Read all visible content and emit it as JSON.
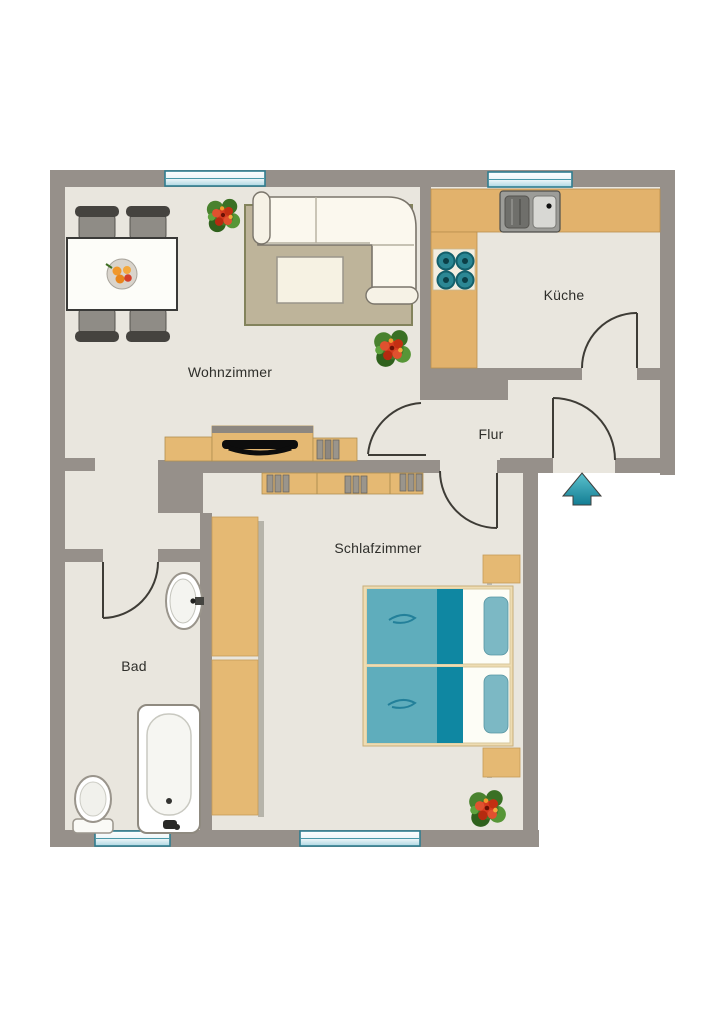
{
  "plan": {
    "type": "apartment-floor-plan",
    "rooms": {
      "wohnzimmer": {
        "label": "Wohnzimmer"
      },
      "kueche": {
        "label": "Küche"
      },
      "flur": {
        "label": "Flur"
      },
      "schlafzimmer": {
        "label": "Schlafzimmer"
      },
      "bad": {
        "label": "Bad"
      }
    },
    "furniture": [
      "dining-table",
      "dining-chair",
      "fruit-bowl",
      "corner-sofa",
      "coffee-table",
      "rug",
      "tv-sideboard",
      "tv",
      "media-rack",
      "plant",
      "kitchen-counter",
      "kitchen-sink",
      "stove",
      "dresser",
      "wardrobe",
      "double-bed",
      "pillow",
      "nightstand",
      "bathtub",
      "toilet",
      "wash-basin",
      "entrance-arrow",
      "window",
      "door"
    ]
  },
  "colors": {
    "wall": "#96908a",
    "floor": "#e9e6de",
    "furniture_wood": "#e5b973",
    "counter_wood": "#e2b26c",
    "rug": "#beb49a",
    "rug_border": "#83835c",
    "sofa": "#fbf8ee",
    "bed_frame": "#eedcb2",
    "bed_blanket": "#5fadbc",
    "bed_band": "#0f87a2",
    "bed_pillow": "#7cb8c4",
    "window_frame": "#2f7d8f",
    "window_glass": "#bfe1ea",
    "entrance_arrow": "#2aa2b4",
    "door_line": "#3e3c36",
    "label_text": "#2e2e2a"
  }
}
